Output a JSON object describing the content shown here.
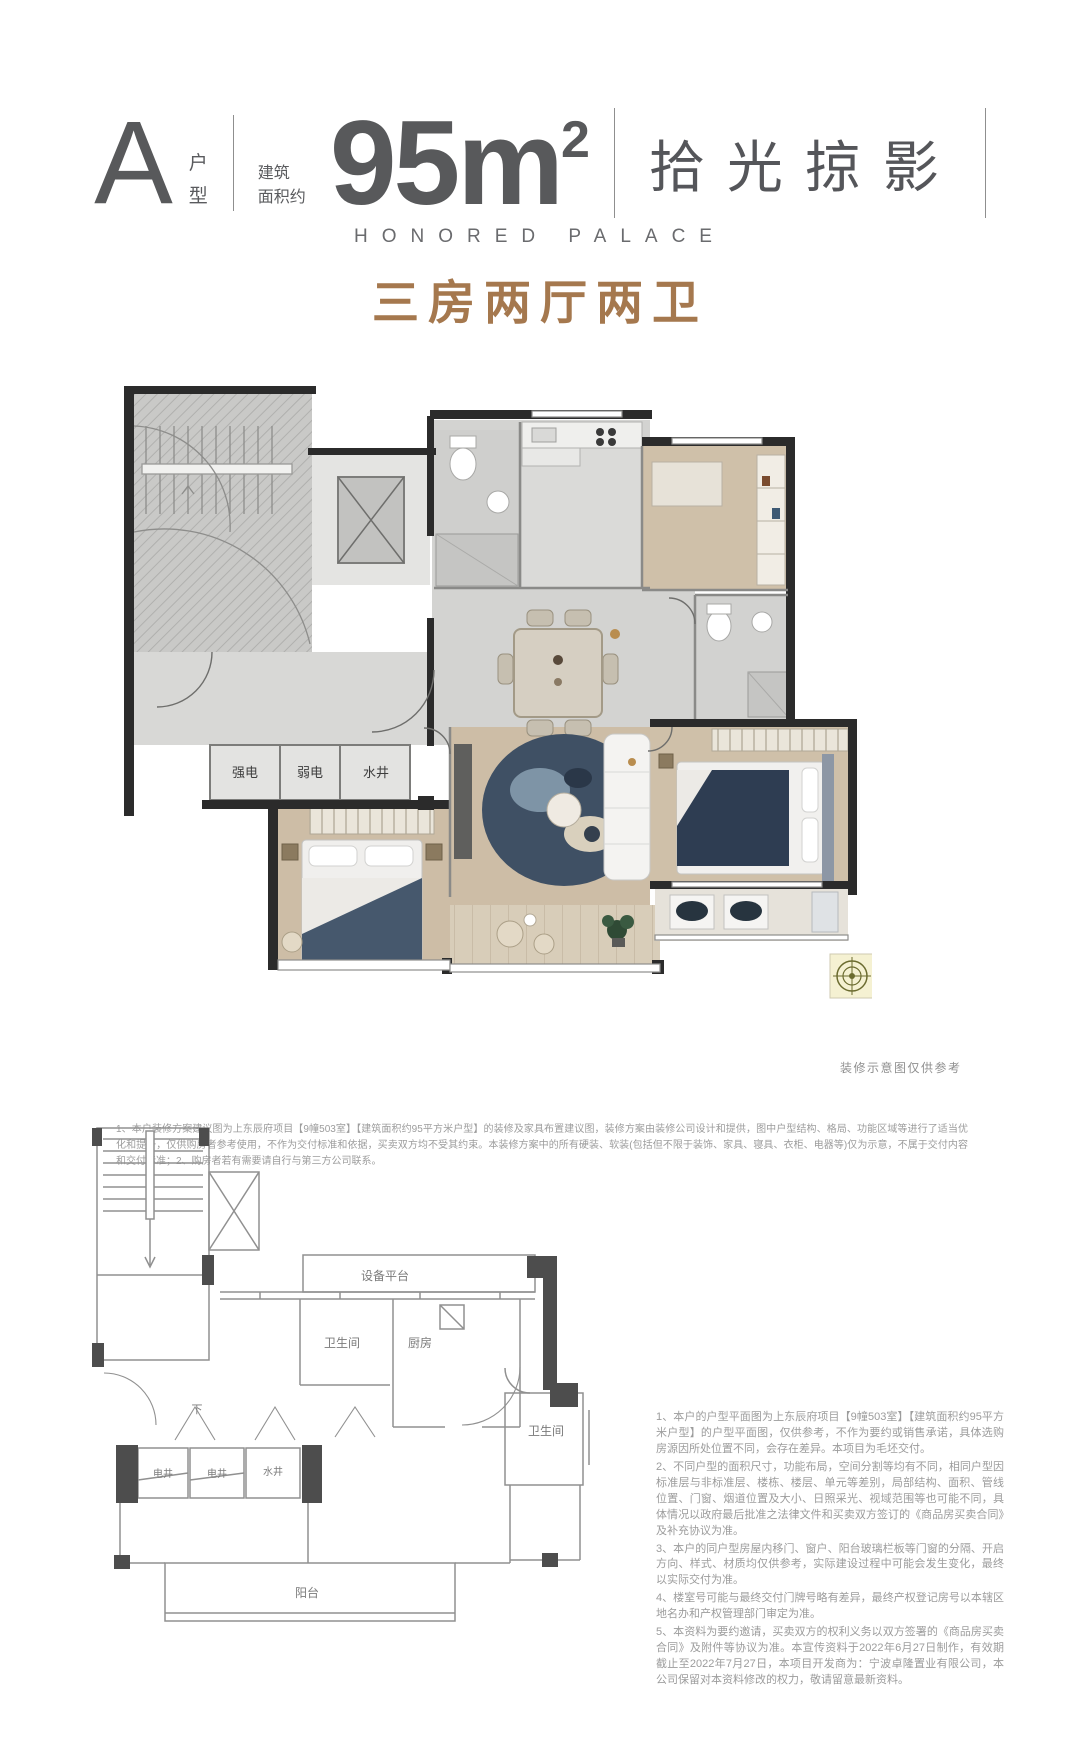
{
  "header": {
    "unit_letter": "A",
    "unit_suffix_1": "户",
    "unit_suffix_2": "型",
    "area_label_1": "建筑",
    "area_label_2": "面积约",
    "area_value": "95m",
    "area_exp": "2",
    "title_cn": "拾光掠影",
    "title_en": "HONORED PALACE",
    "layout_type": "三房两厅两卫",
    "accent_color": "#a5784e",
    "text_color": "#58595b"
  },
  "main_plan": {
    "labels": {
      "strong_power": "强电",
      "weak_power": "弱电",
      "water_shaft": "水井"
    },
    "note": "装修示意图仅供参考"
  },
  "disclaimer_top": "1、本户装修方案建议图为上东辰府项目【9幢503室】【建筑面积约95平方米户型】的装修及家具布置建议图，装修方案由装修公司设计和提供，图中户型结构、格局、功能区域等进行了适当优化和提升，仅供购房者参考使用，不作为交付标准和依据，买卖双方均不受其约束。本装修方案中的所有硬装、软装(包括但不限于装饰、家具、寝具、衣柜、电器等)仅为示意，不属于交付内容和交付标准；2、购房者若有需要请自行与第三方公司联系。",
  "small_plan": {
    "labels": {
      "equipment_platform": "设备平台",
      "bathroom_left": "卫生间",
      "kitchen": "厨房",
      "bathroom_right": "卫生间",
      "shaft_1": "电井",
      "shaft_2": "电井",
      "shaft_3": "水井",
      "stair_down": "下",
      "balcony": "阳台"
    }
  },
  "legal_notes": [
    "1、本户的户型平面图为上东辰府项目【9幢503室】【建筑面积约95平方米户型】的户型平面图，仅供参考，不作为要约或销售承诺，具体选购房源因所处位置不同，会存在差异。本项目为毛坯交付。",
    "2、不同户型的面积尺寸，功能布局，空间分割等均有不同，相同户型因标准层与非标准层、楼栋、楼层、单元等差别，局部结构、面积、管线位置、门窗、烟道位置及大小、日照采光、视域范围等也可能不同，具体情况以政府最后批准之法律文件和买卖双方签订的《商品房买卖合同》及补充协议为准。",
    "3、本户的同户型房屋内移门、窗户、阳台玻璃栏板等门窗的分隔、开启方向、样式、材质均仅供参考，实际建设过程中可能会发生变化，最终以实际交付为准。",
    "4、楼室号可能与最终交付门牌号略有差异，最终产权登记房号以本辖区地名办和产权管理部门审定为准。",
    "5、本资料为要约邀请，买卖双方的权利义务以双方签署的《商品房买卖合同》及附件等协议为准。本宣传资料于2022年6月27日制作，有效期截止至2022年7月27日，本项目开发商为：宁波卓隆置业有限公司，本公司保留对本资料修改的权力，敬请留意最新资料。"
  ]
}
